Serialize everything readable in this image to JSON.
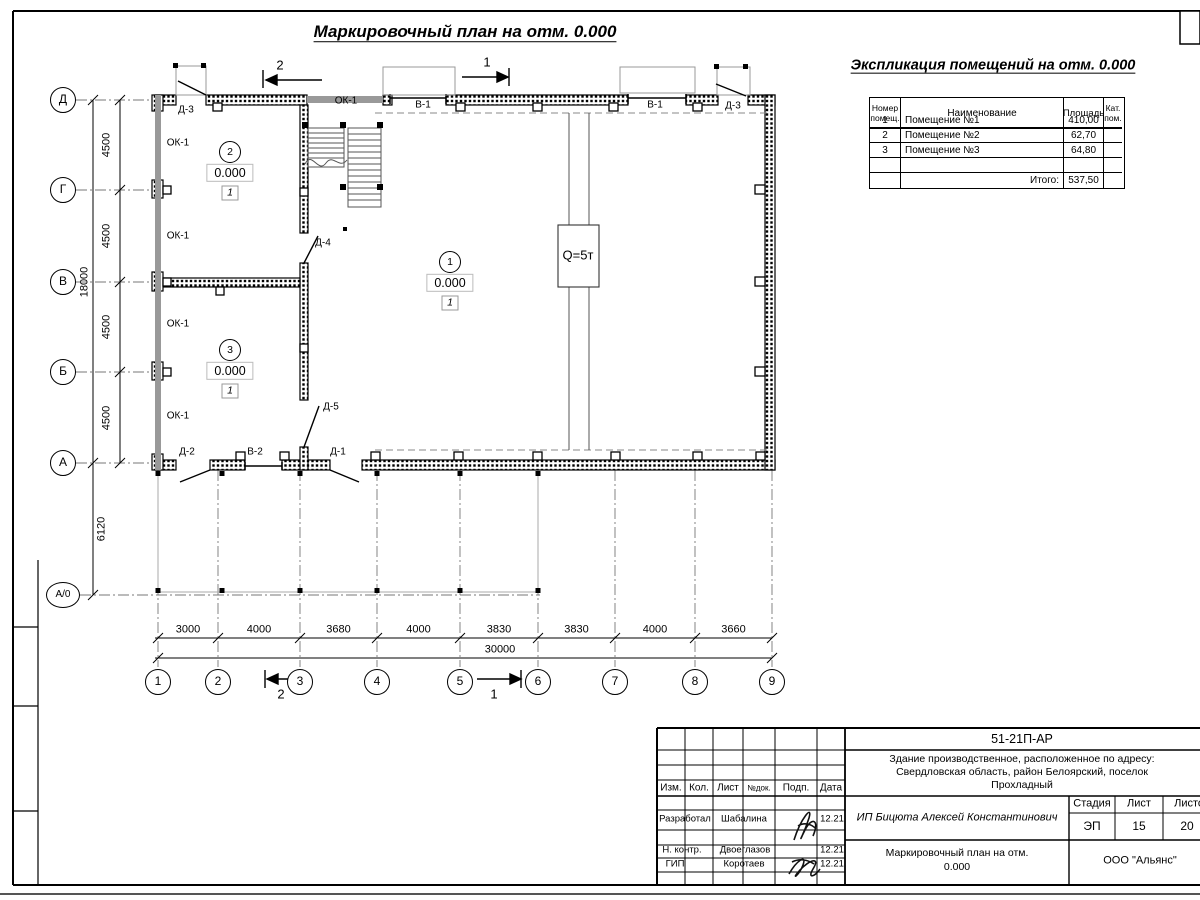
{
  "titles": {
    "plan": "Маркировочный план на отм. 0.000",
    "explication": "Экспликация помещений на отм. 0.000"
  },
  "colors": {
    "line": "#000000",
    "glazing": "#999999",
    "axis_line": "#777777",
    "crane_dash": "#888888"
  },
  "explication_table": {
    "headers": {
      "num": "Номер\nпомещ.",
      "name": "Наименование",
      "area": "Площадь",
      "cat": "Кат.\nпом."
    },
    "rows": [
      [
        "1",
        "Помещение №1",
        "410,00",
        ""
      ],
      [
        "2",
        "Помещение №2",
        "62,70",
        ""
      ],
      [
        "3",
        "Помещение №3",
        "64,80",
        ""
      ],
      [
        "",
        "",
        "",
        ""
      ]
    ],
    "total_label": "Итого:",
    "total_value": "537,50"
  },
  "axes": {
    "vertical": [
      "Д",
      "Г",
      "В",
      "Б",
      "А",
      "А/0"
    ],
    "horizontal": [
      "1",
      "2",
      "3",
      "4",
      "5",
      "6",
      "7",
      "8",
      "9"
    ]
  },
  "dimensions": {
    "vertical_segments": [
      "4500",
      "4500",
      "4500",
      "4500"
    ],
    "vertical_total": "18000",
    "canopy_depth": "6120",
    "horizontal_segments": [
      "3000",
      "4000",
      "3680",
      "4000",
      "3830",
      "3830",
      "4000",
      "3660"
    ],
    "horizontal_total": "30000"
  },
  "plan_labels": [
    {
      "t": "Д-3",
      "x": 186,
      "y": 110
    },
    {
      "t": "ОК-1",
      "x": 346,
      "y": 101
    },
    {
      "t": "В-1",
      "x": 423,
      "y": 105
    },
    {
      "t": "В-1",
      "x": 655,
      "y": 105
    },
    {
      "t": "Д-3",
      "x": 733,
      "y": 106
    },
    {
      "t": "ОК-1",
      "x": 178,
      "y": 143
    },
    {
      "t": "ОК-1",
      "x": 178,
      "y": 236
    },
    {
      "t": "ОК-1",
      "x": 178,
      "y": 324
    },
    {
      "t": "ОК-1",
      "x": 178,
      "y": 416
    },
    {
      "t": "Д-4",
      "x": 323,
      "y": 243
    },
    {
      "t": "Д-5",
      "x": 331,
      "y": 407
    },
    {
      "t": "Д-2",
      "x": 187,
      "y": 452
    },
    {
      "t": "В-2",
      "x": 255,
      "y": 452
    },
    {
      "t": "Д-1",
      "x": 338,
      "y": 452
    }
  ],
  "rooms": [
    {
      "number": "2",
      "level": "0.000",
      "type": "1",
      "x": 230,
      "y": 152
    },
    {
      "number": "1",
      "level": "0.000",
      "type": "1",
      "x": 450,
      "y": 262
    },
    {
      "number": "3",
      "level": "0.000",
      "type": "1",
      "x": 230,
      "y": 350
    }
  ],
  "crane": {
    "label": "Q=5т"
  },
  "sections": {
    "s1": "1",
    "s2": "2"
  },
  "title_block": {
    "doc_number": "51-21П-АР",
    "project_lines": [
      "Здание производственное, расположенное по адресу:",
      "Свердловская область, район Белоярский, поселок",
      "Прохладный"
    ],
    "client": "ИП Бицюта Алексей Константинович",
    "sheet_title_lines": [
      "Маркировочный план на отм.",
      "0.000"
    ],
    "organization": "ООО \"Альянс\"",
    "stage_label": "Стадия",
    "sheet_label": "Лист",
    "sheets_label": "Листов",
    "stage": "ЭП",
    "sheet": "15",
    "sheets": "20",
    "cols": {
      "izm": "Изм.",
      "kol": "Кол.",
      "list": "Лист",
      "doc": "№док.",
      "podp": "Подп.",
      "data": "Дата"
    },
    "roles": [
      {
        "role": "Разработал",
        "name": "Шабалина",
        "date": "12.21"
      },
      {
        "role": "Н. контр.",
        "name": "Двоеглазов",
        "date": "12.21"
      },
      {
        "role": "ГИП",
        "name": "Коротаев",
        "date": "12.21"
      }
    ]
  }
}
